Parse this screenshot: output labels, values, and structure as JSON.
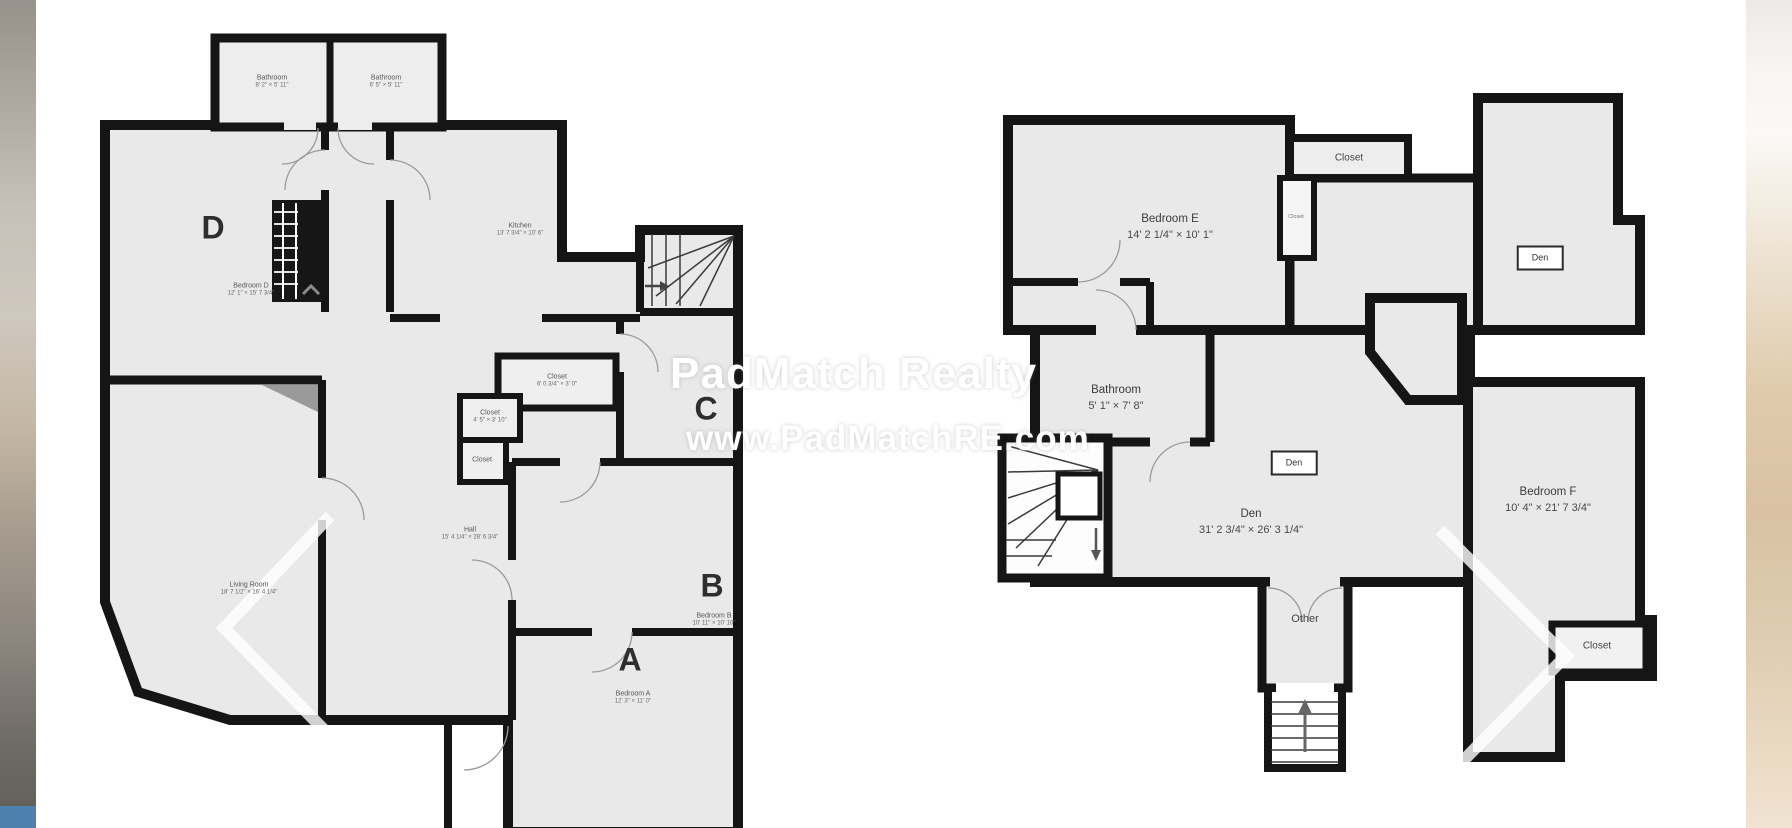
{
  "watermark": {
    "brand": "PadMatch Realty",
    "website": "www.PadMatchRE.com"
  },
  "colors": {
    "wall": "#151515",
    "floor": "#e9e9e9",
    "accent_blue": "#4e80ad",
    "photo_tan": "#d8c2a2"
  },
  "plans": {
    "left": {
      "letters": {
        "a": "A",
        "b": "B",
        "c": "C",
        "d": "D"
      },
      "bath1": {
        "name": "Bathroom",
        "dims": "8' 2\" × 5' 11\""
      },
      "bath2": {
        "name": "Bathroom",
        "dims": "6' 5\" × 5' 11\""
      },
      "bedroom_d": {
        "name": "Bedroom D",
        "dims": "12' 1\" × 15' 7 3/4\""
      },
      "kitchen": {
        "name": "Kitchen",
        "dims": "13' 7 3/4\" × 10' 6\""
      },
      "closet1": {
        "name": "Closet",
        "dims": "6' 0 3/4\" × 3' 0\""
      },
      "closet2": {
        "name": "Closet",
        "dims": "4' 5\" × 3' 10\""
      },
      "closet3": {
        "name": "Closet"
      },
      "hall": {
        "name": "Hall",
        "dims": "15' 4 1/4\" × 28' 6 3/4\""
      },
      "living_room": {
        "name": "Living Room",
        "dims": "18' 7 1/2\" × 16' 4 1/4\""
      },
      "bedroom_b": {
        "name": "Bedroom B",
        "dims": "10' 11\" × 10' 10\""
      },
      "bedroom_a": {
        "name": "Bedroom A",
        "dims": "12' 3\" × 11' 0\""
      }
    },
    "right": {
      "bedroom_e": {
        "name": "Bedroom E",
        "dims": "14' 2 1/4\" × 10' 1\""
      },
      "closet_top": {
        "name": "Closet"
      },
      "closet_small": {
        "name": "Closet"
      },
      "den_box_upper": {
        "name": "Den"
      },
      "den_box_lower": {
        "name": "Den"
      },
      "bathroom": {
        "name": "Bathroom",
        "dims": "5' 1\" × 7' 8\""
      },
      "den": {
        "name": "Den",
        "dims": "31' 2 3/4\" × 26' 3 1/4\""
      },
      "bedroom_f": {
        "name": "Bedroom F",
        "dims": "10' 4\" × 21' 7 3/4\""
      },
      "other": {
        "name": "Other"
      },
      "closet_bottom": {
        "name": "Closet"
      }
    }
  }
}
